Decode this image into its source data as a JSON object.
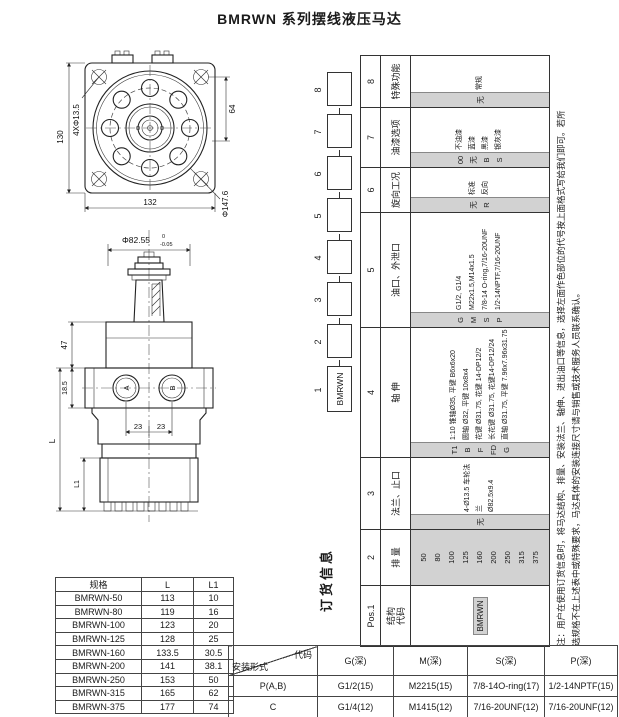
{
  "title": "BMRWN 系列摆线液压马达",
  "front_view": {
    "dim_bolt_holes": "4XΦ13.5",
    "dim_height": "130",
    "dim_pitch": "64",
    "dim_width": "132",
    "dim_pilot_dia": "Φ147.6"
  },
  "side_view": {
    "dim_pilot": "Φ82.55",
    "tol_upper": "0",
    "tol_lower": "-0.05",
    "dim_top": "47",
    "dim_flange": "18.5",
    "dim_overall": "L",
    "dim_port_left": "23",
    "dim_port_right": "23",
    "dim_bottom": "L1",
    "port_a": "A",
    "port_b": "B"
  },
  "ordering": {
    "heading": "订货信息",
    "chain": {
      "numbers": [
        "1",
        "2",
        "3",
        "4",
        "5",
        "6",
        "7",
        "8"
      ],
      "first_box_label": "BMRWN"
    },
    "columns": [
      {
        "pos": "Pos.1",
        "label": "结构\n代码",
        "type": "bar",
        "options": [
          {
            "code": "BMRWN",
            "desc": ""
          }
        ]
      },
      {
        "pos": "2",
        "label": "排 量",
        "type": "full",
        "options": [
          {
            "code": "50"
          },
          {
            "code": "80"
          },
          {
            "code": "100"
          },
          {
            "code": "125"
          },
          {
            "code": "160"
          },
          {
            "code": "200"
          },
          {
            "code": "250"
          },
          {
            "code": "315"
          },
          {
            "code": "375"
          }
        ]
      },
      {
        "pos": "3",
        "label": "法兰、止口",
        "type": "strip",
        "options": [
          {
            "code": "无",
            "desc": "4-Ø13.5 车轮法兰\nØ82.5x9.4"
          }
        ]
      },
      {
        "pos": "4",
        "label": "轴 伸",
        "type": "strip",
        "options": [
          {
            "code": "T1",
            "desc": "1:10 锥轴Ø35, 平键 B6x6x20"
          },
          {
            "code": "B",
            "desc": "圆轴 Ø32, 平键 10x8x4"
          },
          {
            "code": "F",
            "desc": "花键 Ø31.75, 花键 14-DP12/2"
          },
          {
            "code": "FD",
            "desc": "长花键 Ø31.75, 花键14-DP12/24"
          },
          {
            "code": "G",
            "desc": "直轴 Ø31.75, 平键 7.96x7.96x31.75"
          }
        ]
      },
      {
        "pos": "5",
        "label": "油口、外泄口",
        "type": "strip",
        "options": [
          {
            "code": "G",
            "desc": "G1/2, G1/4"
          },
          {
            "code": "M",
            "desc": "M22x1.5,M14x1.5"
          },
          {
            "code": "S",
            "desc": "7/8-14 O-ring,7/16-20UNF"
          },
          {
            "code": "P",
            "desc": "1/2-14NPTF,7/16-20UNF"
          }
        ]
      },
      {
        "pos": "6",
        "label": "旋向工况",
        "type": "strip",
        "options": [
          {
            "code": "无",
            "desc": "标准"
          },
          {
            "code": "R",
            "desc": "反向"
          }
        ]
      },
      {
        "pos": "7",
        "label": "油漆选项",
        "type": "strip",
        "options": [
          {
            "code": "00",
            "desc": "不油漆"
          },
          {
            "code": "无",
            "desc": "蓝漆"
          },
          {
            "code": "B",
            "desc": "黑漆"
          },
          {
            "code": "S",
            "desc": "银灰漆"
          }
        ]
      },
      {
        "pos": "8",
        "label": "特殊功能",
        "type": "strip",
        "options": [
          {
            "code": "无",
            "desc": "常规"
          }
        ]
      }
    ],
    "note_line1": "注：用户在使用订货信息时，将马达结构、排量、安装法兰、轴伸、进出油口等信息，选择左面作色部位的代号按上面格式写给我们即可。若所",
    "note_line2": "选规格不在上述表中或特殊要求，马达具体的安装连接尺寸请与销售或技术服务人员联系确认。"
  },
  "spec_table": {
    "headers": [
      "规格",
      "L",
      "L1"
    ],
    "rows": [
      [
        "BMRWN-50",
        "113",
        "10"
      ],
      [
        "BMRWN-80",
        "119",
        "16"
      ],
      [
        "BMRWN-100",
        "123",
        "20"
      ],
      [
        "BMRWN-125",
        "128",
        "25"
      ],
      [
        "BMRWN-160",
        "133.5",
        "30.5"
      ],
      [
        "BMRWN-200",
        "141",
        "38.1"
      ],
      [
        "BMRWN-250",
        "153",
        "50"
      ],
      [
        "BMRWN-315",
        "165",
        "62"
      ],
      [
        "BMRWN-375",
        "177",
        "74"
      ]
    ]
  },
  "port_table": {
    "corner_top": "代码",
    "corner_bottom": "安装形式",
    "headers": [
      "G(深)",
      "M(深)",
      "S(深)",
      "P(深)"
    ],
    "rows": [
      {
        "label": "P(A,B)",
        "values": [
          "G1/2(15)",
          "M2215(15)",
          "7/8-14O-ring(17)",
          "1/2-14NPTF(15)"
        ]
      },
      {
        "label": "C",
        "values": [
          "G1/4(12)",
          "M1415(12)",
          "7/16-20UNF(12)",
          "7/16-20UNF(12)"
        ]
      }
    ]
  },
  "colors": {
    "code_strip": "#d2d2d2",
    "line": "#222222"
  }
}
